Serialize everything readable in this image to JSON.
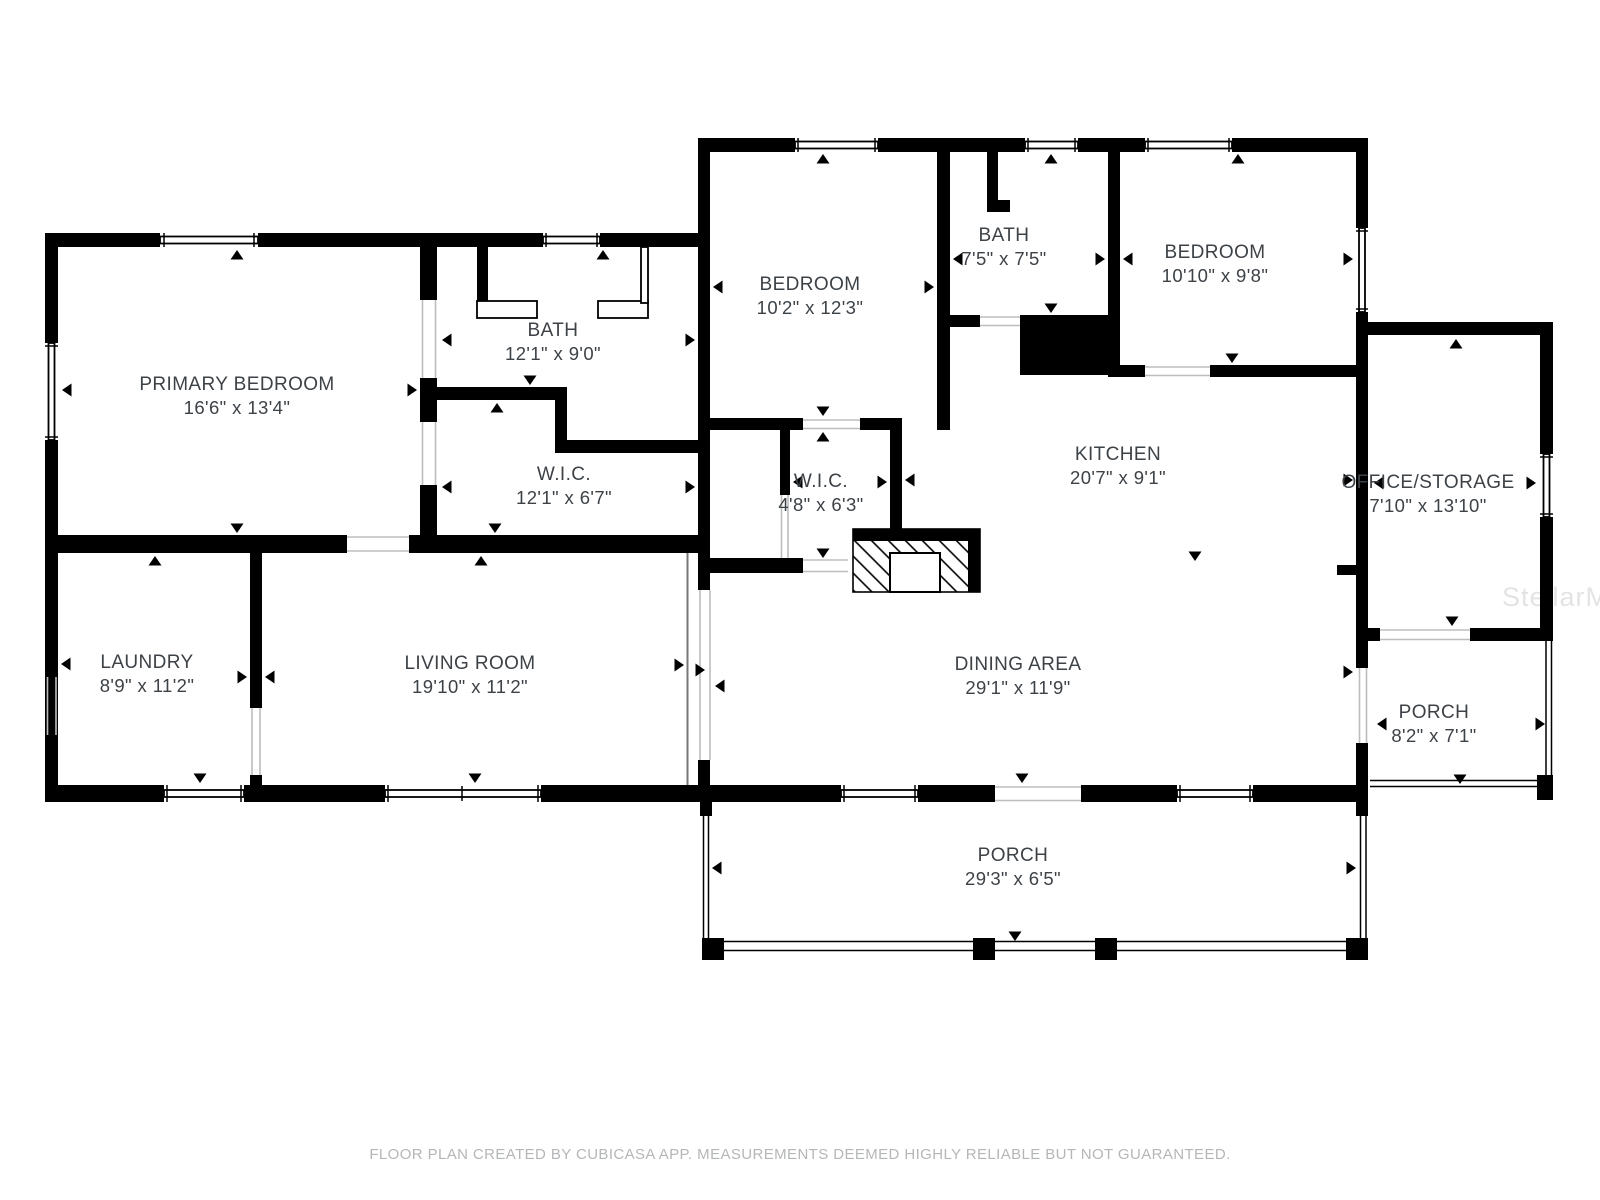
{
  "page": {
    "background": "#ffffff",
    "wall_color": "#000000",
    "label_color": "#3d4247",
    "watermark": "StellarMLS",
    "footer": "FLOOR PLAN CREATED BY CUBICASA APP. MEASUREMENTS DEEMED HIGHLY RELIABLE BUT NOT GUARANTEED."
  },
  "rooms": {
    "primary_bedroom": {
      "name": "PRIMARY BEDROOM",
      "dims": "16'6\" x 13'4\""
    },
    "bath_main": {
      "name": "BATH",
      "dims": "12'1\" x 9'0\""
    },
    "wic_main": {
      "name": "W.I.C.",
      "dims": "12'1\" x 6'7\""
    },
    "laundry": {
      "name": "LAUNDRY",
      "dims": "8'9\" x 11'2\""
    },
    "living_room": {
      "name": "LIVING ROOM",
      "dims": "19'10\" x 11'2\""
    },
    "bedroom_middle": {
      "name": "BEDROOM",
      "dims": "10'2\" x 12'3\""
    },
    "bath_hall": {
      "name": "BATH",
      "dims": "7'5\" x 7'5\""
    },
    "bedroom_right": {
      "name": "BEDROOM",
      "dims": "10'10\" x 9'8\""
    },
    "wic_small": {
      "name": "W.I.C.",
      "dims": "4'8\" x 6'3\""
    },
    "kitchen": {
      "name": "KITCHEN",
      "dims": "20'7\" x 9'1\""
    },
    "dining_area": {
      "name": "DINING AREA",
      "dims": "29'1\" x 11'9\""
    },
    "office_storage": {
      "name": "OFFICE/STORAGE",
      "dims": "7'10\" x 13'10\""
    },
    "porch_right": {
      "name": "PORCH",
      "dims": "8'2\" x 7'1\""
    },
    "porch_bottom": {
      "name": "PORCH",
      "dims": "29'3\" x 6'5\""
    }
  }
}
